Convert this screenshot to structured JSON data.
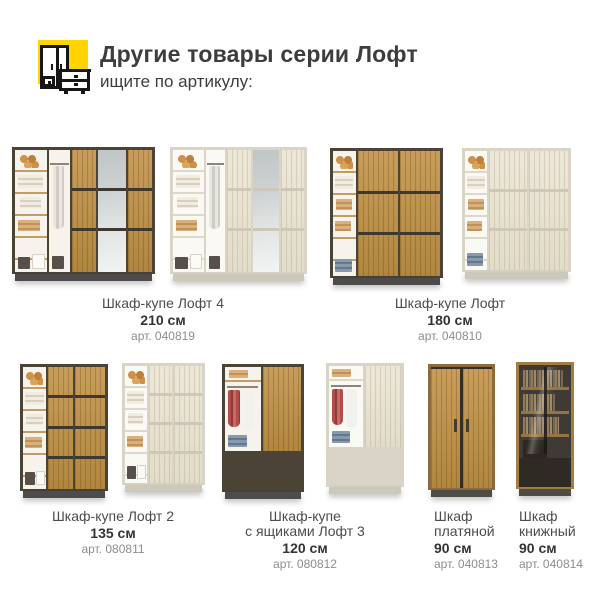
{
  "header": {
    "title": "Другие товары серии Лофт",
    "subtitle": "ищите по артикулу:",
    "icon": {
      "name": "wardrobe-dresser-icon",
      "background": "#FFD400"
    }
  },
  "products": [
    {
      "name": "Шкаф-купе Лофт 4",
      "size": "210 см",
      "article": "арт. 040819",
      "variants": [
        "dark-oak",
        "light-oak"
      ]
    },
    {
      "name": "Шкаф-купе Лофт",
      "size": "180 см",
      "article": "арт. 040810",
      "variants": [
        "dark-oak",
        "light-oak"
      ]
    },
    {
      "name": "Шкаф-купе Лофт 2",
      "size": "135 см",
      "article": "арт. 080811",
      "variants": [
        "dark-oak",
        "light-oak"
      ]
    },
    {
      "name": "Шкаф-купе\nс ящиками Лофт 3",
      "size": "120 см",
      "article": "арт. 080812",
      "variants": [
        "dark-oak",
        "light-oak"
      ]
    },
    {
      "name": "Шкаф\nплатяной",
      "size": "90 см",
      "article": "арт. 040813",
      "variants": [
        "oak"
      ]
    },
    {
      "name": "Шкаф\nкнижный",
      "size": "90 см",
      "article": "арт. 040814",
      "variants": [
        "oak"
      ]
    }
  ],
  "colors": {
    "accent_yellow": "#FFD400",
    "dark_wood": "#C1924E",
    "light_wood": "#ECE7D8",
    "dark_frame": "#4A4336",
    "light_carcass": "#D9D4C6",
    "plinth": "#4D4C4A",
    "text": "#3D3D3D",
    "muted_text": "#8D8D8D"
  }
}
